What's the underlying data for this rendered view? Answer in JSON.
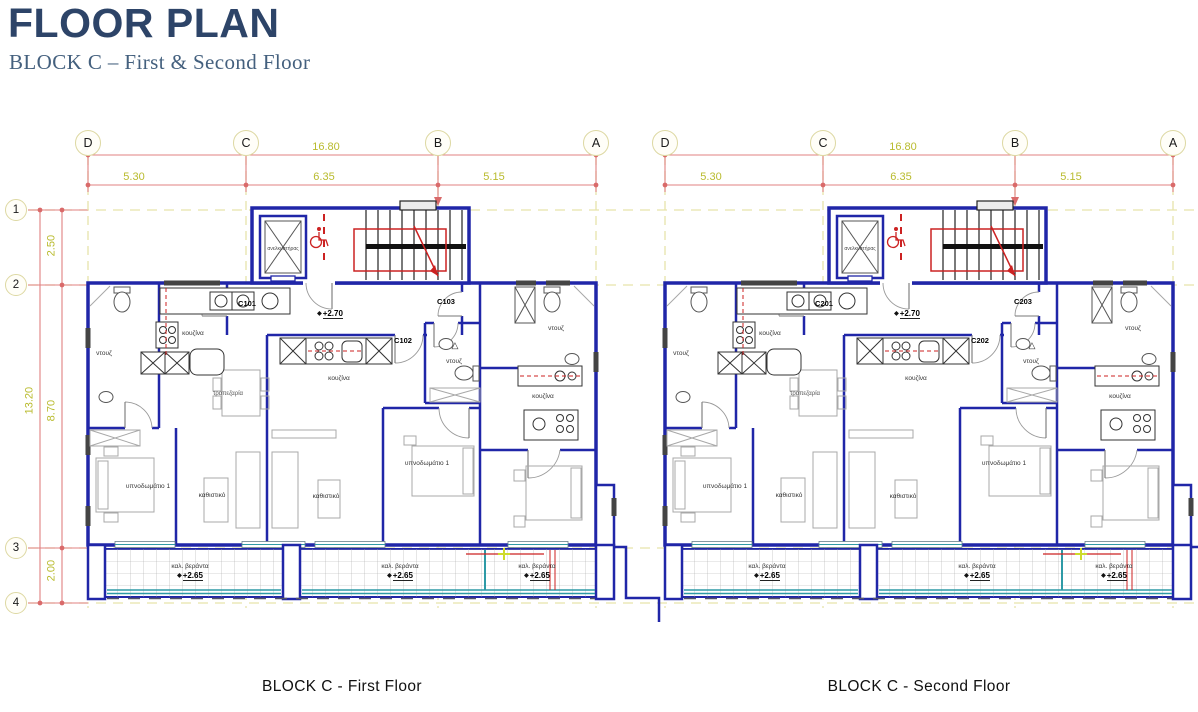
{
  "header": {
    "title": "FLOOR PLAN",
    "subtitle": "BLOCK C – First & Second Floor"
  },
  "grid": {
    "columns": [
      "D",
      "C",
      "B",
      "A"
    ],
    "rows": [
      "1",
      "2",
      "3",
      "4"
    ],
    "width_total": "16.80",
    "width_segments": [
      "5.30",
      "6.35",
      "5.15"
    ],
    "height_total": "13.20",
    "height_segments": [
      "2.50",
      "8.70",
      "2.00"
    ]
  },
  "labels": {
    "elevator": "ανελκυστήρας",
    "kitchen": "κουζίνα",
    "shower": "ντουζ",
    "dining": "τραπεζαρία",
    "bedroom": "υπνοδωμάτιο 1",
    "living": "καθιστικό",
    "veranda": "καλ. βεράντα"
  },
  "levels": {
    "hall": "+2.70",
    "veranda": "+2.65"
  },
  "icons": {
    "level_marker": "◆",
    "shower_drain": "△"
  },
  "plans": [
    {
      "caption": "BLOCK C - First Floor",
      "units": {
        "left": "C101",
        "middle": "C102",
        "right": "C103"
      }
    },
    {
      "caption": "BLOCK C - Second Floor",
      "units": {
        "left": "C201",
        "middle": "C202",
        "right": "C203"
      }
    }
  ],
  "colors": {
    "wall": "#2026a8",
    "dimension_line": "#e08080",
    "dimension_text": "#b9bb2e",
    "grid_dash": "#e6e3ab",
    "annotation_red": "#cc2222",
    "railing_teal": "#2e9aa6",
    "title": "#2d4468",
    "subtitle": "#44607e"
  }
}
